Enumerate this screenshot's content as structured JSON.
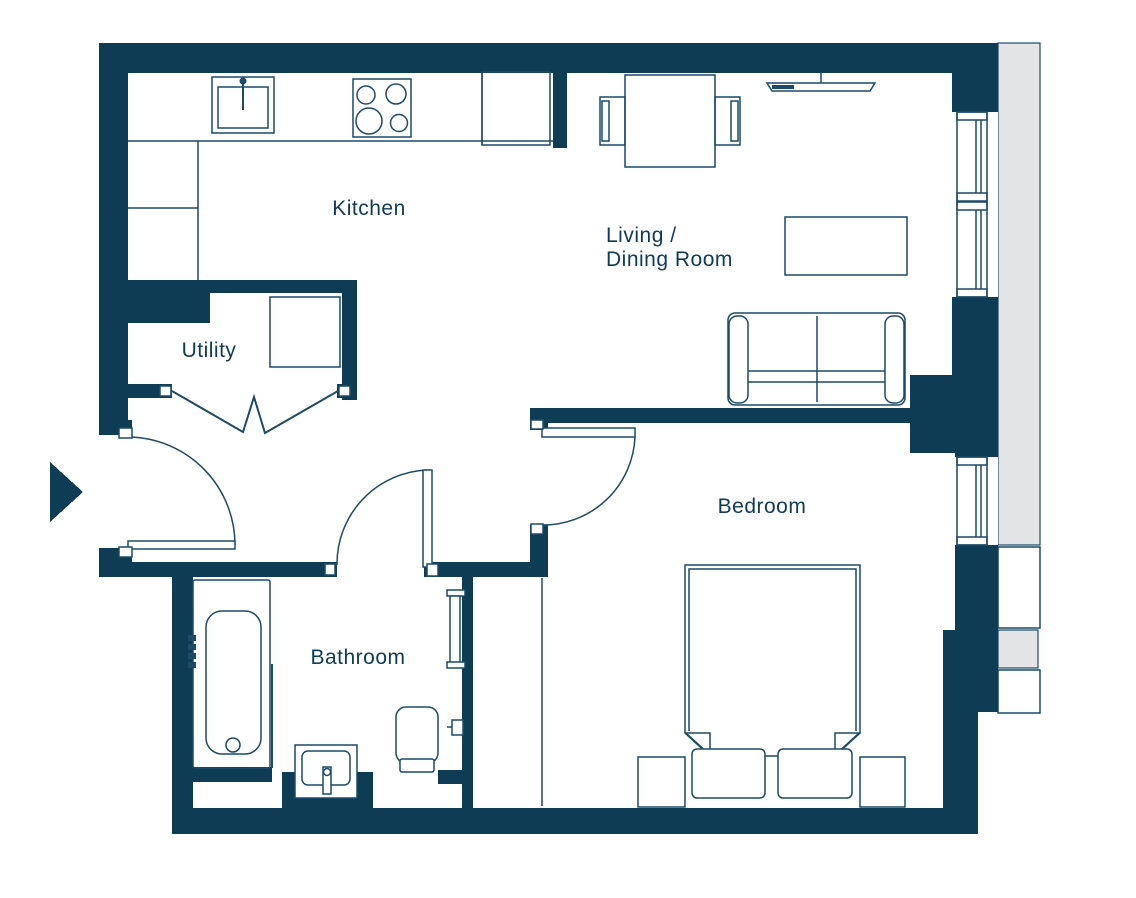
{
  "colors": {
    "wall": "#0e3c55",
    "line": "#1a4b68",
    "exterior_fill": "#e2e4e6",
    "background": "#ffffff"
  },
  "rooms": {
    "kitchen": {
      "label": "Kitchen"
    },
    "living_dining": {
      "label_line1": "Living /",
      "label_line2": "Dining Room"
    },
    "utility": {
      "label": "Utility"
    },
    "bathroom": {
      "label": "Bathroom"
    },
    "bedroom": {
      "label": "Bedroom"
    }
  },
  "entrance": {
    "indicator": "entrance-arrow"
  },
  "fixtures": {
    "kitchen": [
      "sink",
      "hob",
      "tall-unit",
      "worktop"
    ],
    "living_dining": [
      "dining-table",
      "dining-chairs",
      "wall-tv",
      "coffee-table",
      "sofa"
    ],
    "utility": [
      "washing-machine",
      "bifold-doors"
    ],
    "bathroom": [
      "bathtub",
      "shower-screen",
      "shower-controls",
      "basin",
      "toilet",
      "towel-radiator",
      "toilet-roll-holder"
    ],
    "bedroom": [
      "double-bed",
      "pillows",
      "bedside-tables",
      "wardrobe-line"
    ],
    "windows": [
      "living-room-window",
      "bedroom-window"
    ],
    "doors": [
      "entrance-door",
      "bathroom-door",
      "bedroom-door",
      "utility-bifold-doors"
    ]
  }
}
